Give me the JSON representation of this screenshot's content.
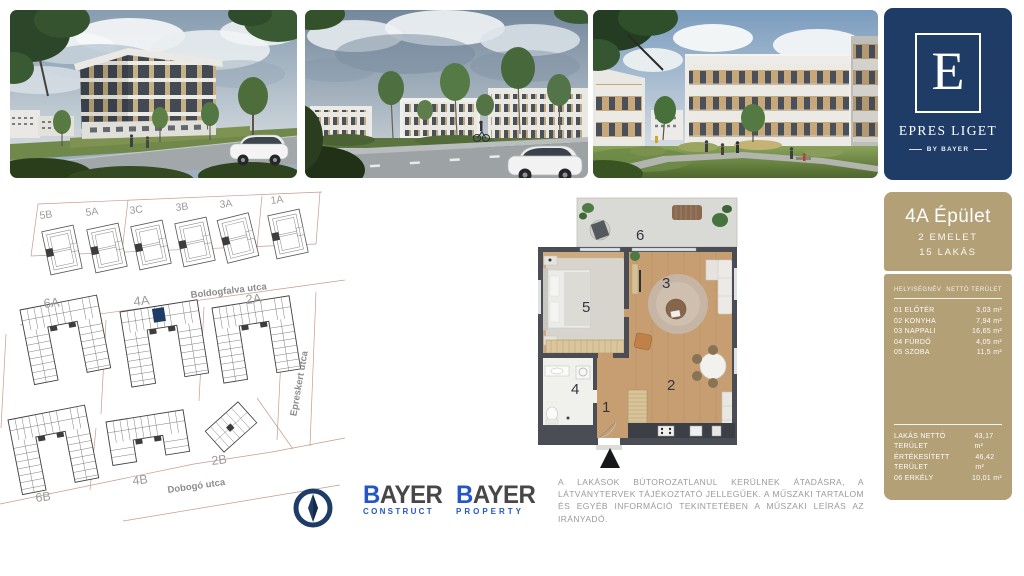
{
  "brand": {
    "letter": "E",
    "name": "EPRES LIGET",
    "byline": "BY BAYER"
  },
  "unit": {
    "title": "4A Épület",
    "floor": "2 EMELET",
    "count": "15 LAKÁS",
    "table": {
      "col_name": "HELYISÉGNÉV",
      "col_area": "NETTÓ TERÜLET",
      "rows": [
        {
          "name": "01 ELŐTÉR",
          "area": "3,03 m²"
        },
        {
          "name": "02 KONYHA",
          "area": "7,94 m²"
        },
        {
          "name": "03 NAPPALI",
          "area": "16,65 m²"
        },
        {
          "name": "04 FÜRDŐ",
          "area": "4,05 m²"
        },
        {
          "name": "05 SZOBA",
          "area": "11,5 m²"
        }
      ]
    },
    "totals": [
      {
        "name": "LAKÁS NETTÓ TERÜLET",
        "area": "43,17 m²"
      },
      {
        "name": "ÉRTÉKESÍTETT TERÜLET",
        "area": "46,42 m²"
      },
      {
        "name": "06 ERKÉLY",
        "area": "10,01 m²"
      }
    ]
  },
  "site_plan": {
    "labels": {
      "top": [
        "5B",
        "5A",
        "3C",
        "3B",
        "3A",
        "1A"
      ],
      "mid": [
        "6A",
        "4A",
        "2A"
      ],
      "bottom": [
        "6B",
        "4B",
        "2B"
      ]
    },
    "streets": [
      "Boldogfalva utca",
      "Epreskert utca",
      "Dobogó utca"
    ]
  },
  "floor_plan": {
    "rooms": [
      "1",
      "2",
      "3",
      "4",
      "5",
      "6"
    ]
  },
  "logos": {
    "b": "B",
    "rest": "AYER",
    "construct": "CONSTRUCT",
    "property": "PROPERTY"
  },
  "disclaimer": {
    "text": "A LAKÁSOK BÚTOROZATLANUL KERÜLNEK ÁTADÁSRA, A LÁTVÁNYTERVEK TÁJÉKOZTATÓ JELLEGŰEK. A MŰSZAKI TARTALOM ÉS EGYÉB INFORMÁCIÓ TEKINTETÉBEN A MŰSZAKI LEÍRÁS AZ IRÁNYADÓ."
  },
  "colors": {
    "navy": "#1e3c66",
    "tan": "#b3a077",
    "bayer_blue": "#2457c5",
    "highlight": "#1e3c66"
  }
}
